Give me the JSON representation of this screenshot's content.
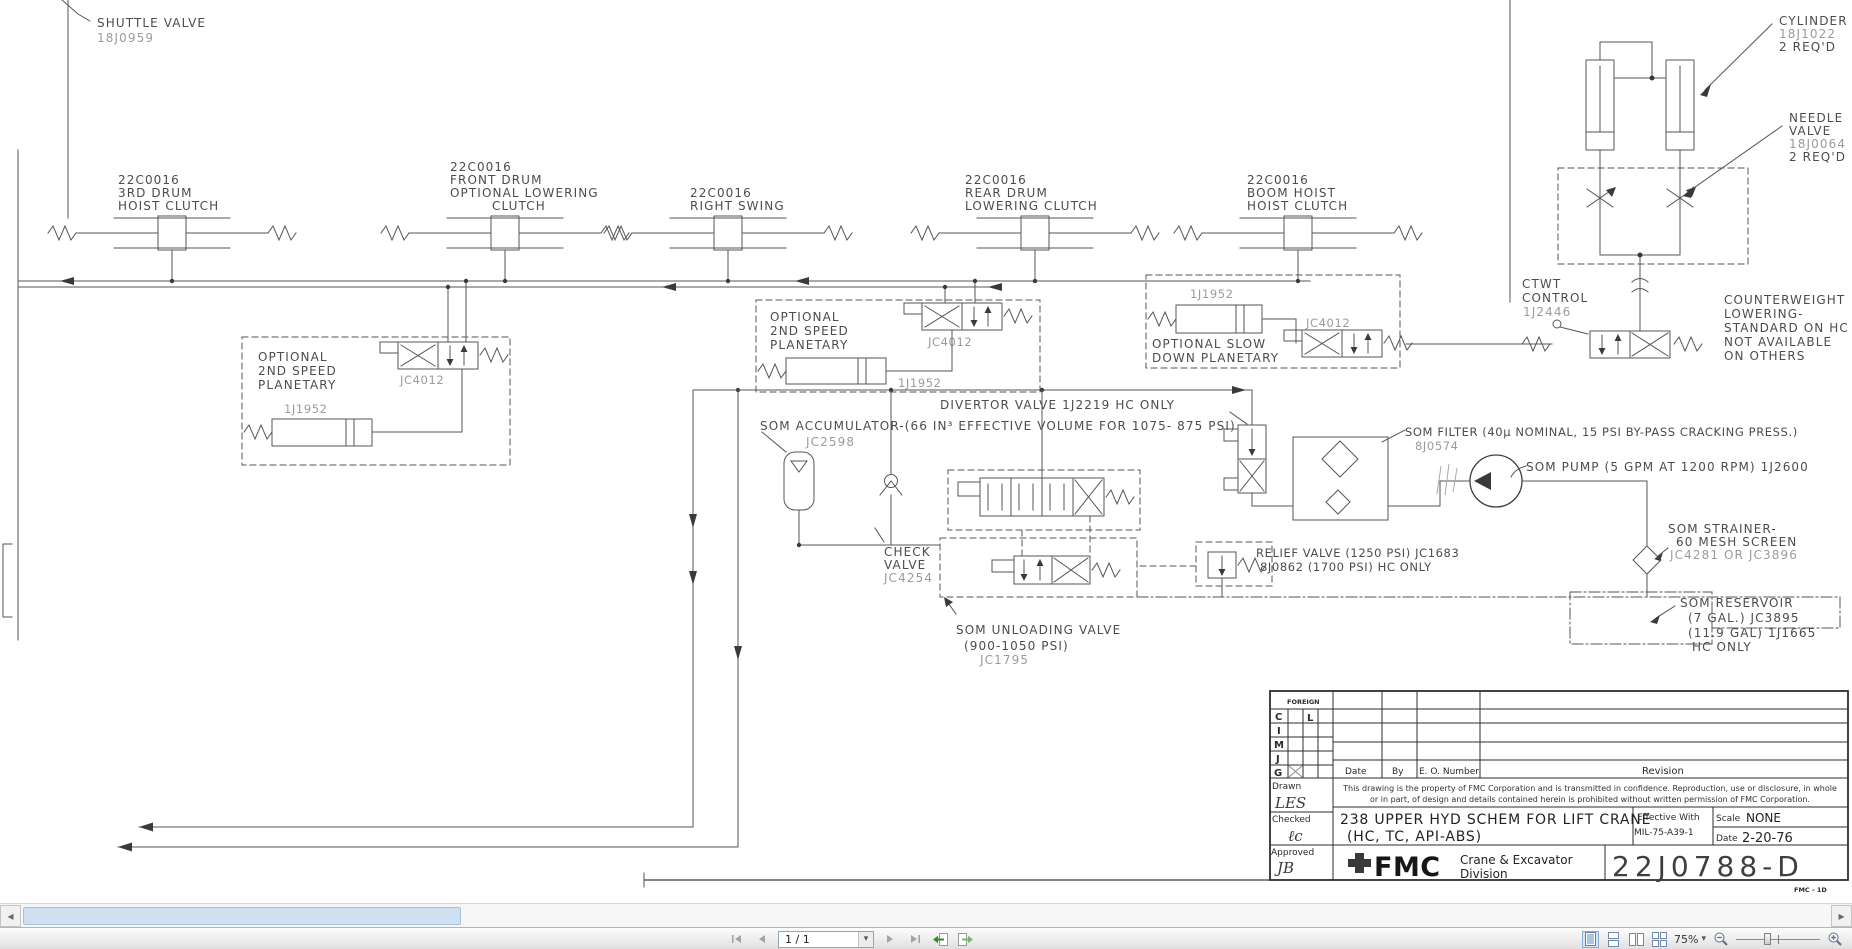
{
  "viewer": {
    "page_indicator": "1 / 1",
    "zoom_level": "75%",
    "icons": {
      "scroll_left": "◂",
      "scroll_right": "▸",
      "caret": "▾"
    }
  },
  "schematic": {
    "shuttle_valve": {
      "name": "SHUTTLE VALVE",
      "part": "18J0959"
    },
    "clutches": [
      {
        "l1": "22C0016",
        "l2": "3RD DRUM",
        "l3": "HOIST CLUTCH"
      },
      {
        "l1": "22C0016",
        "l2": "FRONT DRUM",
        "l3": "OPTIONAL LOWERING",
        "l4": "CLUTCH"
      },
      {
        "l1": "22C0016",
        "l2": "RIGHT SWING"
      },
      {
        "l1": "22C0016",
        "l2": "REAR DRUM",
        "l3": "LOWERING CLUTCH"
      },
      {
        "l1": "22C0016",
        "l2": "BOOM HOIST",
        "l3": "HOIST CLUTCH"
      }
    ],
    "planetary_left": {
      "l1": "OPTIONAL",
      "l2": "2ND SPEED",
      "l3": "PLANETARY",
      "valve": "JC4012",
      "cylinder": "1J1952"
    },
    "planetary_center": {
      "l1": "OPTIONAL",
      "l2": "2ND SPEED",
      "l3": "PLANETARY",
      "valve": "JC4012",
      "cylinder": "1J1952"
    },
    "planetary_right": {
      "cylinder": "1J1952",
      "l1": "OPTIONAL SLOW",
      "l2": "DOWN PLANETARY",
      "valve": "JC4012"
    },
    "ctwt_control": {
      "l1": "CTWT",
      "l2": "CONTROL",
      "l3": "1J2446"
    },
    "counterweight_note": {
      "l1": "COUNTERWEIGHT",
      "l2": "LOWERING-",
      "l3": "STANDARD ON HC",
      "l4": "NOT AVAILABLE",
      "l5": "ON OTHERS"
    },
    "cylinder_label": {
      "l1": "CYLINDER",
      "l2": "18J1022",
      "l3": "2 REQ'D"
    },
    "needle_valve_label": {
      "l1": "NEEDLE",
      "l2": "VALVE",
      "l3": "18J0064",
      "l4": "2 REQ'D"
    },
    "divertor_label": "DIVERTOR VALVE 1J2219 HC ONLY",
    "accumulator_label": {
      "l1": "SOM ACCUMULATOR-(66 IN³ EFFECTIVE VOLUME FOR 1075- 875 PSI)",
      "part": "JC2598"
    },
    "filter_label": {
      "l1": "SOM FILTER (40μ NOMINAL, 15 PSI BY-PASS CRACKING PRESS.)",
      "part": "8J0574"
    },
    "pump_label": "SOM PUMP (5 GPM AT 1200 RPM) 1J2600",
    "check_valve_label": {
      "l1": "CHECK",
      "l2": "VALVE",
      "l3": "JC4254"
    },
    "relief_label": {
      "l1": "RELIEF VALVE (1250 PSI) JC1683",
      "l2": "8J0862 (1700 PSI) HC ONLY"
    },
    "unloading_label": {
      "l1": "SOM UNLOADING VALVE",
      "l2": "(900-1050 PSI)",
      "l3": "JC1795"
    },
    "strainer_label": {
      "l1": "SOM STRAINER-",
      "l2": "60 MESH SCREEN",
      "l3": "JC4281 OR JC3896"
    },
    "reservoir_label": {
      "l1": "SOM RESERVOIR",
      "l2": "(7 GAL.) JC3895",
      "l3": "(11.9 GAL) 1J1665",
      "l4": "HC ONLY"
    }
  },
  "title_block": {
    "foreign": "FOREIGN",
    "rows": [
      "C",
      "I",
      "M",
      "J",
      "G"
    ],
    "row_c_mark": "L",
    "col_date": "Date",
    "col_by": "By",
    "col_eo": "E. O. Number",
    "col_revision": "Revision",
    "drawn_label": "Drawn",
    "drawn_sig": "LES",
    "checked_label": "Checked",
    "checked_sig": "ℓc",
    "approved_label": "Approved",
    "approved_sig": "JB",
    "property_line1": "This drawing is the property of FMC Corporation and is transmitted in confidence. Reproduction, use or disclosure, in whole",
    "property_line2": "or in part, of design and details contained herein is prohibited without written permission of FMC Corporation.",
    "title_line1": "238 UPPER HYD SCHEM FOR LIFT CRANE",
    "title_line2": "(HC, TC, API-ABS)",
    "effective_label": "Effective With",
    "effective_value": "MIL-75-A39-1",
    "scale_label": "Scale",
    "scale_value": "NONE",
    "date_label": "Date",
    "date_value": "2-20-76",
    "logo": "FMC",
    "division_line1": "Crane & Excavator",
    "division_line2": "Division",
    "drawing_number": "22J0788-D",
    "footnote": "FMC - 1D"
  }
}
